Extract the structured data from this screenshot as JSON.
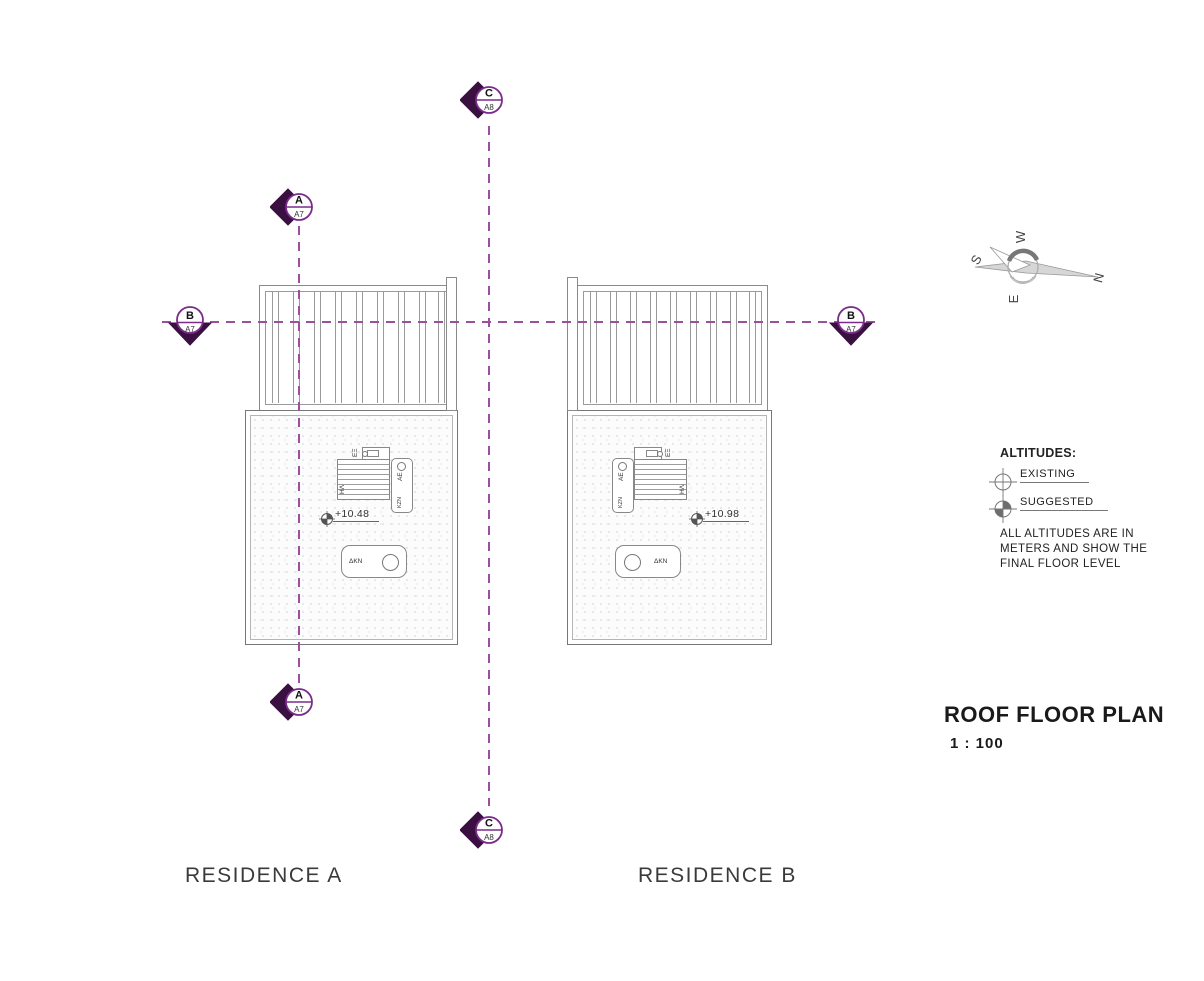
{
  "markers": {
    "c_top": {
      "letter": "C",
      "sheet": "A8"
    },
    "a_top": {
      "letter": "A",
      "sheet": "A7"
    },
    "b_left": {
      "letter": "B",
      "sheet": "A7"
    },
    "b_right": {
      "letter": "B",
      "sheet": "A7"
    },
    "a_bottom": {
      "letter": "A",
      "sheet": "A7"
    },
    "c_bottom": {
      "letter": "C",
      "sheet": "A8"
    }
  },
  "compass": {
    "north": "N",
    "south": "S",
    "east": "E",
    "west": "W"
  },
  "legend": {
    "title": "ALTITUDES:",
    "existing_label": "EXISTING",
    "suggested_label": "SUGGESTED",
    "note": "ALL ALTITUDES ARE IN METERS AND SHOW THE FINAL FLOOR LEVEL"
  },
  "title_block": {
    "title": "ROOF FLOOR PLAN",
    "scale": "1 : 100"
  },
  "residence_a": {
    "name": "RESIDENCE A",
    "altitude": "+10.48",
    "labels": {
      "solar": "ΗΛ",
      "vent": "ΕΞ",
      "ae": "ΑΕ",
      "kzn": "ΚΖΝ",
      "chimney": "ΔΚΝ"
    }
  },
  "residence_b": {
    "name": "RESIDENCE B",
    "altitude": "+10.98",
    "labels": {
      "solar": "ΗΛ",
      "vent": "ΕΞ",
      "ae": "ΑΕ",
      "kzn": "ΚΖΝ",
      "chimney": "ΔΚΝ"
    }
  },
  "colors": {
    "marker_fill": "#3a1040",
    "marker_stroke": "#7b2b8b",
    "section_line": "#9c4f9f",
    "drawing_line": "#8a8a8a"
  }
}
